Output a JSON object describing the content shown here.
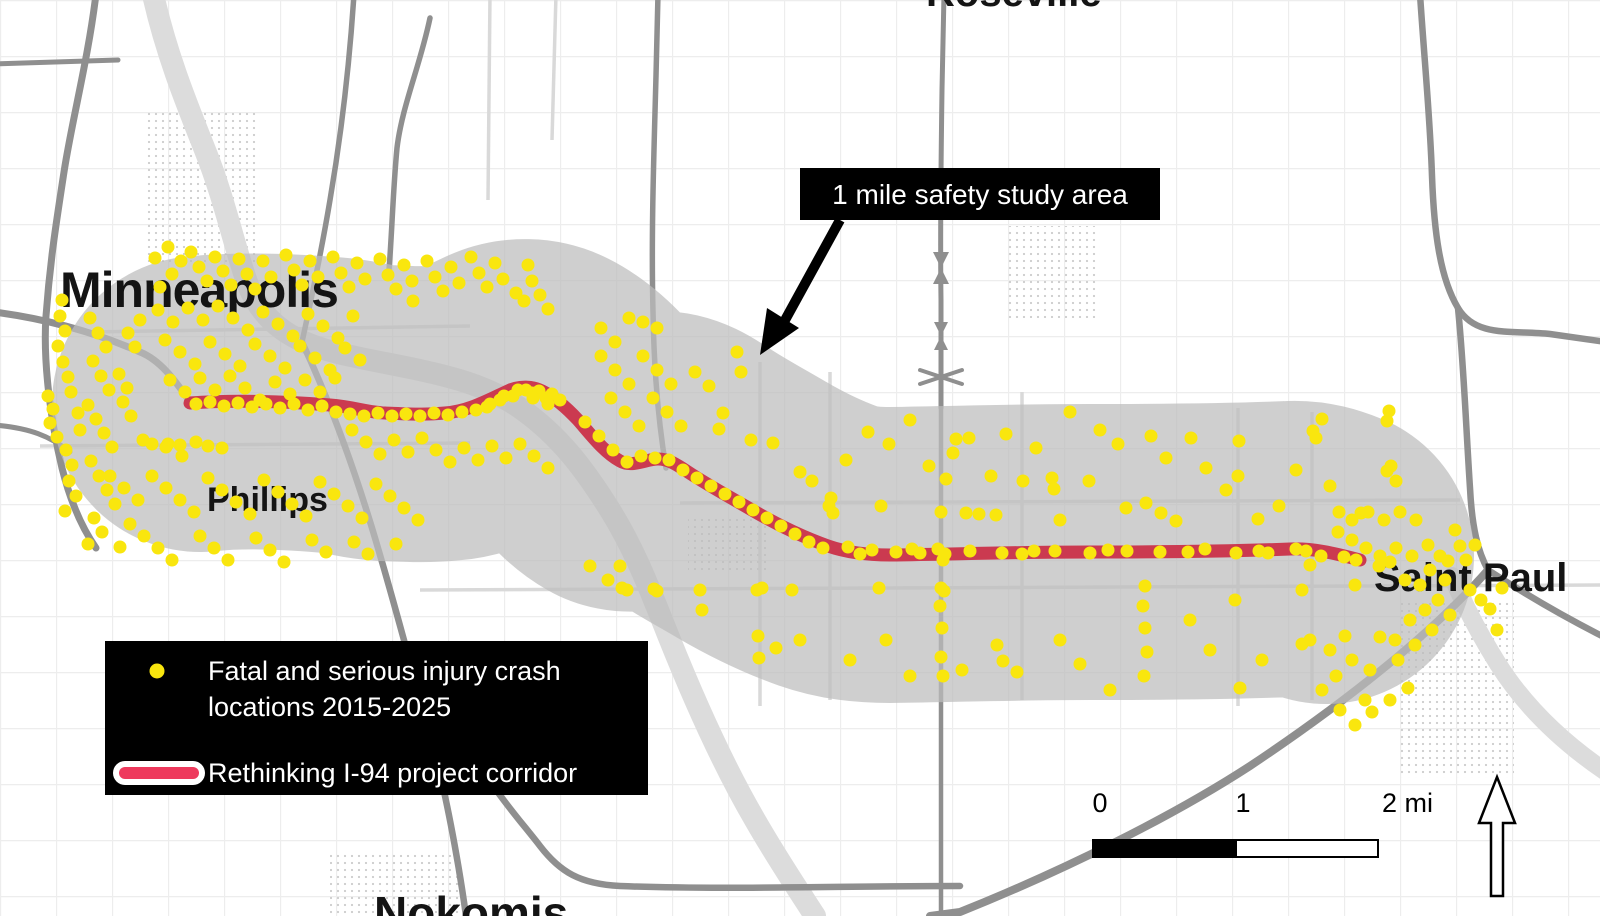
{
  "title": "Rethinking I-94 corridor safety study map",
  "colors": {
    "study_area": "#bdbdbd",
    "corridor_red": "#cb3a50",
    "legend_swatch_red": "#ee3a5d",
    "crash_dot": "#f9e60e",
    "callout_bg": "#000000",
    "legend_bg": "#000000"
  },
  "labels": {
    "cities": [
      {
        "text": "Minneapolis"
      },
      {
        "text": "Phillips"
      },
      {
        "text": "Saint Paul"
      },
      {
        "text": "Roseville"
      },
      {
        "text": "Nokomis"
      }
    ]
  },
  "callout": {
    "text": "1 mile safety study area"
  },
  "legend": {
    "item1_line1": "Fatal and serious injury crash",
    "item1_line2": "locations 2015-2025",
    "item2": "Rethinking I-94 project corridor"
  },
  "scale_bar": {
    "tick0": "0",
    "tick1": "1",
    "tick2": "2 mi"
  },
  "corridor": {
    "path": "M190,403 C230,400 282,401 330,405 C355,407 365,412 385,413 C410,414 425,415 445,413 C470,411 490,399 510,390 C520,386 532,386 542,391 C552,396 565,406 578,420 C592,436 604,452 620,461 C632,468 646,459 658,459 C668,459 676,464 688,472 C706,484 728,496 752,510 C776,524 800,536 828,546 C848,553 868,555 890,555 C960,554 1020,552 1090,552 C1160,552 1240,551 1290,549 C1312,548 1334,553 1360,560",
    "buffer_path": "M200,404 C236,400 282,401 330,405 C355,407 365,412 385,413 C410,414 425,415 445,413 C470,411 490,399 510,390 C520,386 532,386 542,391 C552,396 565,406 578,420 C592,436 604,452 620,461 C632,468 646,459 658,459 C668,459 676,464 688,472 C706,484 728,496 752,510 C776,524 800,536 828,546 C848,553 868,555 890,555 C960,554 1020,552 1090,552 C1160,552 1240,551 1290,549 C1305,548 1316,552 1326,556"
  },
  "crash_points": [
    [
      48,
      396
    ],
    [
      53,
      409
    ],
    [
      50,
      423
    ],
    [
      57,
      437
    ],
    [
      62,
      300
    ],
    [
      60,
      316
    ],
    [
      65,
      331
    ],
    [
      58,
      346
    ],
    [
      63,
      362
    ],
    [
      68,
      377
    ],
    [
      71,
      392
    ],
    [
      66,
      450
    ],
    [
      72,
      465
    ],
    [
      69,
      481
    ],
    [
      76,
      496
    ],
    [
      65,
      511
    ],
    [
      80,
      430
    ],
    [
      78,
      413
    ],
    [
      90,
      318
    ],
    [
      98,
      333
    ],
    [
      106,
      347
    ],
    [
      93,
      361
    ],
    [
      101,
      376
    ],
    [
      109,
      390
    ],
    [
      88,
      405
    ],
    [
      96,
      419
    ],
    [
      104,
      433
    ],
    [
      112,
      447
    ],
    [
      91,
      461
    ],
    [
      99,
      476
    ],
    [
      107,
      490
    ],
    [
      115,
      504
    ],
    [
      94,
      518
    ],
    [
      102,
      532
    ],
    [
      123,
      402
    ],
    [
      131,
      416
    ],
    [
      127,
      388
    ],
    [
      119,
      374
    ],
    [
      135,
      347
    ],
    [
      128,
      333
    ],
    [
      140,
      320
    ],
    [
      88,
      544
    ],
    [
      120,
      547
    ],
    [
      143,
      440
    ],
    [
      155,
      258
    ],
    [
      168,
      247
    ],
    [
      181,
      261
    ],
    [
      172,
      274
    ],
    [
      160,
      287
    ],
    [
      191,
      252
    ],
    [
      199,
      267
    ],
    [
      207,
      281
    ],
    [
      215,
      257
    ],
    [
      223,
      271
    ],
    [
      231,
      285
    ],
    [
      239,
      259
    ],
    [
      247,
      274
    ],
    [
      255,
      289
    ],
    [
      263,
      261
    ],
    [
      271,
      277
    ],
    [
      286,
      255
    ],
    [
      294,
      270
    ],
    [
      302,
      285
    ],
    [
      310,
      261
    ],
    [
      318,
      277
    ],
    [
      333,
      257
    ],
    [
      341,
      273
    ],
    [
      349,
      287
    ],
    [
      357,
      263
    ],
    [
      365,
      279
    ],
    [
      380,
      259
    ],
    [
      388,
      275
    ],
    [
      396,
      289
    ],
    [
      404,
      265
    ],
    [
      412,
      281
    ],
    [
      427,
      261
    ],
    [
      435,
      277
    ],
    [
      443,
      291
    ],
    [
      451,
      267
    ],
    [
      459,
      283
    ],
    [
      471,
      257
    ],
    [
      479,
      273
    ],
    [
      487,
      287
    ],
    [
      495,
      263
    ],
    [
      503,
      279
    ],
    [
      516,
      293
    ],
    [
      524,
      301
    ],
    [
      532,
      281
    ],
    [
      540,
      295
    ],
    [
      548,
      309
    ],
    [
      528,
      265
    ],
    [
      413,
      301
    ],
    [
      158,
      310
    ],
    [
      173,
      322
    ],
    [
      188,
      308
    ],
    [
      203,
      320
    ],
    [
      218,
      306
    ],
    [
      233,
      318
    ],
    [
      248,
      330
    ],
    [
      263,
      312
    ],
    [
      278,
      324
    ],
    [
      293,
      336
    ],
    [
      308,
      314
    ],
    [
      323,
      326
    ],
    [
      338,
      338
    ],
    [
      353,
      316
    ],
    [
      165,
      340
    ],
    [
      180,
      352
    ],
    [
      195,
      364
    ],
    [
      210,
      342
    ],
    [
      225,
      354
    ],
    [
      240,
      366
    ],
    [
      255,
      344
    ],
    [
      270,
      356
    ],
    [
      285,
      368
    ],
    [
      300,
      346
    ],
    [
      315,
      358
    ],
    [
      330,
      370
    ],
    [
      345,
      348
    ],
    [
      360,
      360
    ],
    [
      170,
      380
    ],
    [
      185,
      392
    ],
    [
      200,
      378
    ],
    [
      215,
      390
    ],
    [
      230,
      376
    ],
    [
      245,
      388
    ],
    [
      260,
      400
    ],
    [
      275,
      382
    ],
    [
      290,
      394
    ],
    [
      305,
      380
    ],
    [
      320,
      392
    ],
    [
      335,
      378
    ],
    [
      196,
      404
    ],
    [
      210,
      402
    ],
    [
      224,
      406
    ],
    [
      238,
      403
    ],
    [
      252,
      407
    ],
    [
      266,
      404
    ],
    [
      280,
      408
    ],
    [
      294,
      404
    ],
    [
      308,
      410
    ],
    [
      322,
      406
    ],
    [
      336,
      412
    ],
    [
      350,
      414
    ],
    [
      364,
      416
    ],
    [
      378,
      413
    ],
    [
      392,
      416
    ],
    [
      406,
      414
    ],
    [
      420,
      416
    ],
    [
      434,
      413
    ],
    [
      448,
      415
    ],
    [
      462,
      412
    ],
    [
      476,
      410
    ],
    [
      490,
      404
    ],
    [
      504,
      396
    ],
    [
      518,
      390
    ],
    [
      532,
      393
    ],
    [
      546,
      398
    ],
    [
      352,
      430
    ],
    [
      366,
      442
    ],
    [
      380,
      454
    ],
    [
      394,
      440
    ],
    [
      408,
      452
    ],
    [
      422,
      438
    ],
    [
      436,
      450
    ],
    [
      450,
      462
    ],
    [
      464,
      448
    ],
    [
      478,
      460
    ],
    [
      492,
      446
    ],
    [
      506,
      458
    ],
    [
      520,
      444
    ],
    [
      534,
      456
    ],
    [
      548,
      468
    ],
    [
      168,
      444
    ],
    [
      182,
      456
    ],
    [
      196,
      442
    ],
    [
      152,
      444
    ],
    [
      166,
      447
    ],
    [
      180,
      445
    ],
    [
      208,
      446
    ],
    [
      222,
      448
    ],
    [
      110,
      476
    ],
    [
      124,
      488
    ],
    [
      138,
      500
    ],
    [
      152,
      476
    ],
    [
      166,
      488
    ],
    [
      180,
      500
    ],
    [
      194,
      512
    ],
    [
      208,
      478
    ],
    [
      222,
      490
    ],
    [
      236,
      502
    ],
    [
      250,
      514
    ],
    [
      264,
      480
    ],
    [
      278,
      492
    ],
    [
      292,
      504
    ],
    [
      306,
      516
    ],
    [
      320,
      482
    ],
    [
      334,
      494
    ],
    [
      348,
      506
    ],
    [
      362,
      518
    ],
    [
      376,
      484
    ],
    [
      390,
      496
    ],
    [
      404,
      508
    ],
    [
      418,
      520
    ],
    [
      130,
      524
    ],
    [
      144,
      536
    ],
    [
      158,
      548
    ],
    [
      172,
      560
    ],
    [
      200,
      536
    ],
    [
      214,
      548
    ],
    [
      228,
      560
    ],
    [
      256,
      538
    ],
    [
      270,
      550
    ],
    [
      284,
      562
    ],
    [
      312,
      540
    ],
    [
      326,
      552
    ],
    [
      354,
      542
    ],
    [
      368,
      554
    ],
    [
      396,
      544
    ],
    [
      601,
      356
    ],
    [
      615,
      370
    ],
    [
      629,
      384
    ],
    [
      643,
      356
    ],
    [
      657,
      370
    ],
    [
      671,
      384
    ],
    [
      611,
      398
    ],
    [
      625,
      412
    ],
    [
      639,
      426
    ],
    [
      653,
      398
    ],
    [
      667,
      412
    ],
    [
      681,
      426
    ],
    [
      723,
      413
    ],
    [
      719,
      429
    ],
    [
      695,
      372
    ],
    [
      709,
      386
    ],
    [
      737,
      352
    ],
    [
      751,
      440
    ],
    [
      741,
      372
    ],
    [
      629,
      318
    ],
    [
      643,
      322
    ],
    [
      657,
      328
    ],
    [
      615,
      342
    ],
    [
      601,
      328
    ],
    [
      585,
      422
    ],
    [
      599,
      436
    ],
    [
      613,
      450
    ],
    [
      627,
      462
    ],
    [
      641,
      456
    ],
    [
      655,
      458
    ],
    [
      669,
      460
    ],
    [
      683,
      470
    ],
    [
      697,
      478
    ],
    [
      711,
      486
    ],
    [
      725,
      494
    ],
    [
      739,
      502
    ],
    [
      753,
      510
    ],
    [
      767,
      518
    ],
    [
      781,
      526
    ],
    [
      795,
      534
    ],
    [
      809,
      542
    ],
    [
      823,
      548
    ],
    [
      487,
      407
    ],
    [
      500,
      400
    ],
    [
      513,
      396
    ],
    [
      526,
      390
    ],
    [
      539,
      391
    ],
    [
      552,
      394
    ],
    [
      560,
      400
    ],
    [
      548,
      404
    ],
    [
      533,
      398
    ],
    [
      773,
      443
    ],
    [
      800,
      472
    ],
    [
      812,
      481
    ],
    [
      831,
      498
    ],
    [
      829,
      506
    ],
    [
      833,
      513
    ],
    [
      881,
      506
    ],
    [
      929,
      466
    ],
    [
      956,
      439
    ],
    [
      953,
      453
    ],
    [
      946,
      479
    ],
    [
      969,
      438
    ],
    [
      991,
      476
    ],
    [
      1023,
      481
    ],
    [
      941,
      512
    ],
    [
      966,
      513
    ],
    [
      979,
      514
    ],
    [
      996,
      515
    ],
    [
      1070,
      412
    ],
    [
      1052,
      478
    ],
    [
      1054,
      489
    ],
    [
      1089,
      481
    ],
    [
      1126,
      508
    ],
    [
      1146,
      503
    ],
    [
      1161,
      513
    ],
    [
      1176,
      521
    ],
    [
      1151,
      436
    ],
    [
      1166,
      458
    ],
    [
      1191,
      438
    ],
    [
      1239,
      441
    ],
    [
      1238,
      476
    ],
    [
      1258,
      519
    ],
    [
      1279,
      506
    ],
    [
      1313,
      431
    ],
    [
      1316,
      438
    ],
    [
      1322,
      419
    ],
    [
      1339,
      512
    ],
    [
      1361,
      513
    ],
    [
      1389,
      411
    ],
    [
      1387,
      421
    ],
    [
      1391,
      466
    ],
    [
      1387,
      471
    ],
    [
      1396,
      481
    ],
    [
      868,
      432
    ],
    [
      889,
      444
    ],
    [
      910,
      420
    ],
    [
      1006,
      434
    ],
    [
      1036,
      448
    ],
    [
      1100,
      430
    ],
    [
      1118,
      444
    ],
    [
      1206,
      468
    ],
    [
      1226,
      490
    ],
    [
      1296,
      470
    ],
    [
      1330,
      486
    ],
    [
      846,
      460
    ],
    [
      1060,
      520
    ],
    [
      848,
      547
    ],
    [
      872,
      550
    ],
    [
      896,
      552
    ],
    [
      920,
      553
    ],
    [
      945,
      554
    ],
    [
      943,
      560
    ],
    [
      938,
      549
    ],
    [
      970,
      551
    ],
    [
      1002,
      553
    ],
    [
      1034,
      551
    ],
    [
      1055,
      551
    ],
    [
      1090,
      553
    ],
    [
      1127,
      551
    ],
    [
      1160,
      552
    ],
    [
      1205,
      549
    ],
    [
      1236,
      553
    ],
    [
      1259,
      551
    ],
    [
      1296,
      549
    ],
    [
      1321,
      556
    ],
    [
      1356,
      560
    ],
    [
      1390,
      562
    ],
    [
      1379,
      566
    ],
    [
      860,
      554
    ],
    [
      912,
      549
    ],
    [
      1022,
      554
    ],
    [
      1108,
      550
    ],
    [
      1188,
      552
    ],
    [
      1268,
      553
    ],
    [
      1306,
      551
    ],
    [
      1344,
      557
    ],
    [
      608,
      580
    ],
    [
      622,
      588
    ],
    [
      627,
      590
    ],
    [
      654,
      589
    ],
    [
      657,
      591
    ],
    [
      700,
      590
    ],
    [
      702,
      610
    ],
    [
      757,
      590
    ],
    [
      762,
      588
    ],
    [
      792,
      590
    ],
    [
      879,
      588
    ],
    [
      941,
      588
    ],
    [
      944,
      591
    ],
    [
      590,
      566
    ],
    [
      620,
      566
    ],
    [
      940,
      606
    ],
    [
      942,
      628
    ],
    [
      941,
      657
    ],
    [
      943,
      676
    ],
    [
      962,
      670
    ],
    [
      997,
      645
    ],
    [
      1003,
      661
    ],
    [
      1017,
      672
    ],
    [
      758,
      636
    ],
    [
      759,
      658
    ],
    [
      776,
      648
    ],
    [
      800,
      640
    ],
    [
      850,
      660
    ],
    [
      886,
      640
    ],
    [
      910,
      676
    ],
    [
      1060,
      640
    ],
    [
      1080,
      664
    ],
    [
      1110,
      690
    ],
    [
      1143,
      606
    ],
    [
      1145,
      628
    ],
    [
      1147,
      652
    ],
    [
      1144,
      676
    ],
    [
      1190,
      620
    ],
    [
      1210,
      650
    ],
    [
      1240,
      688
    ],
    [
      1262,
      660
    ],
    [
      1302,
      644
    ],
    [
      1145,
      586
    ],
    [
      1235,
      600
    ],
    [
      1310,
      565
    ],
    [
      1302,
      590
    ],
    [
      1310,
      640
    ],
    [
      1330,
      650
    ],
    [
      1345,
      636
    ],
    [
      1355,
      585
    ],
    [
      1365,
      700
    ],
    [
      1380,
      637
    ],
    [
      1395,
      640
    ],
    [
      1405,
      580
    ],
    [
      1420,
      585
    ],
    [
      1430,
      570
    ],
    [
      1440,
      556
    ],
    [
      1448,
      561
    ],
    [
      1455,
      530
    ],
    [
      1460,
      546
    ],
    [
      1470,
      590
    ],
    [
      1481,
      600
    ],
    [
      1490,
      609
    ],
    [
      1502,
      588
    ],
    [
      1497,
      630
    ],
    [
      1322,
      690
    ],
    [
      1340,
      710
    ],
    [
      1355,
      725
    ],
    [
      1372,
      712
    ],
    [
      1390,
      700
    ],
    [
      1408,
      688
    ],
    [
      1398,
      660
    ],
    [
      1415,
      645
    ],
    [
      1432,
      630
    ],
    [
      1450,
      615
    ],
    [
      1438,
      600
    ],
    [
      1425,
      610
    ],
    [
      1370,
      670
    ],
    [
      1352,
      660
    ],
    [
      1336,
      676
    ],
    [
      1410,
      620
    ],
    [
      1445,
      580
    ],
    [
      1466,
      560
    ],
    [
      1475,
      545
    ],
    [
      1428,
      545
    ],
    [
      1412,
      556
    ],
    [
      1396,
      548
    ],
    [
      1380,
      556
    ],
    [
      1366,
      548
    ],
    [
      1352,
      540
    ],
    [
      1338,
      532
    ],
    [
      1352,
      520
    ],
    [
      1368,
      512
    ],
    [
      1384,
      520
    ],
    [
      1400,
      512
    ],
    [
      1416,
      520
    ]
  ]
}
